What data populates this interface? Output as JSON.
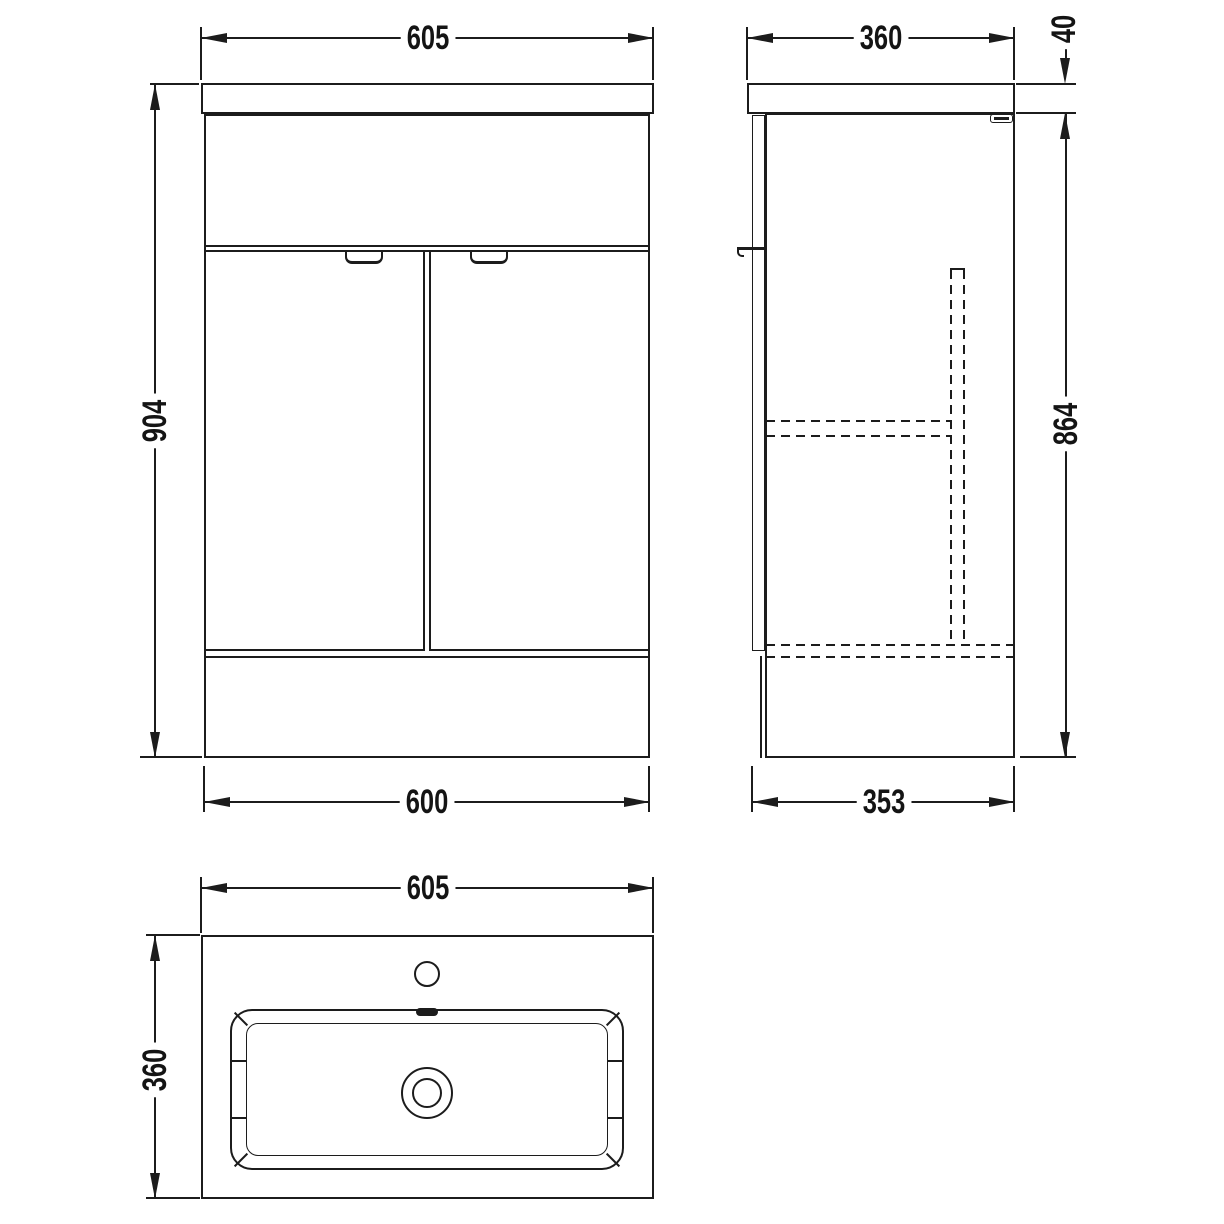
{
  "drawing": {
    "title": "Vanity unit and basin technical drawing",
    "line_color": "#1c1c1c",
    "views": {
      "front": {
        "label": "front-elevation",
        "dims": {
          "top_width": "605",
          "height": "904",
          "bottom_width": "600"
        }
      },
      "side": {
        "label": "side-elevation",
        "dims": {
          "top_depth": "360",
          "worktop_thickness": "40",
          "cabinet_height": "864",
          "bottom_depth": "353"
        }
      },
      "plan": {
        "label": "basin-plan-view",
        "dims": {
          "width": "605",
          "depth": "360"
        }
      }
    }
  }
}
